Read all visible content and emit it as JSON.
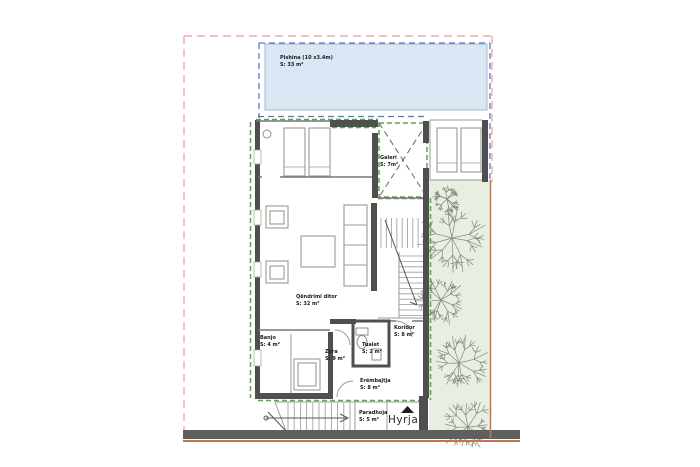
{
  "labels": {
    "pool": {
      "name": "Pishina (10 x3.4m)",
      "area": "S: 33 m²"
    },
    "gallery": {
      "name": "Galeri",
      "area": "S: 7m²"
    },
    "living": {
      "name": "Qëndrimi ditor",
      "area": "S: 32 m²"
    },
    "bath": {
      "name": "Banjo",
      "area": "S: 4 m²"
    },
    "office": {
      "name": "Zyra",
      "area": "S: 9 m²"
    },
    "toilet": {
      "name": "Tualet",
      "area": "S: 2 m²"
    },
    "corridor": {
      "name": "Koridor",
      "area": "S: 8 m²"
    },
    "windbreak": {
      "name": "Erëmbajtja",
      "area": "S: 8 m²"
    },
    "porch": {
      "name": "Paradhoja",
      "area": "S: 5 m²"
    },
    "entrance": {
      "name": "Hyrja"
    }
  },
  "colors": {
    "pool": "#d9e6f3",
    "pooledge": "#a9b6c6",
    "garden": "#e6efe2",
    "wall": "#4f4f4f",
    "pink": "#f2aba8",
    "blue": "#5b76c8",
    "green": "#58a944",
    "orange": "#c0774e",
    "band": "#5f5f5f",
    "tree": "#828a7e",
    "text": "#1b1b1b"
  }
}
